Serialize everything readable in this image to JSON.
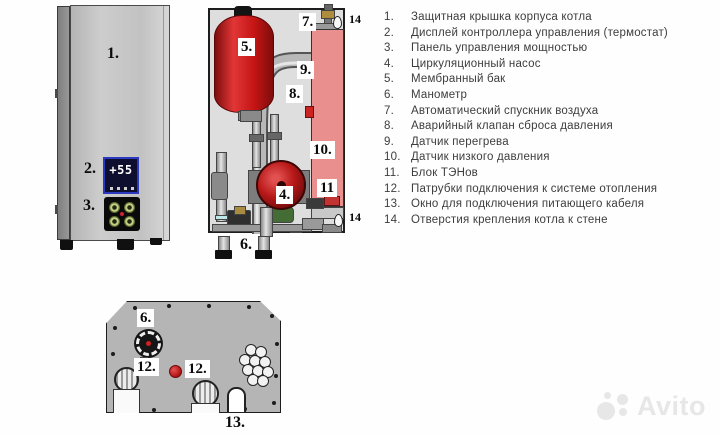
{
  "colors": {
    "tank_red": "#c41414",
    "pump_red": "#b81818",
    "heater_pink": "#e9908f",
    "panel_grey": "#c2c2c2",
    "display_navy": "#0e0e2e",
    "display_border_blue": "#2b38c0",
    "button_green": "#c3cf84",
    "watermark_grey": "#e3e3e3"
  },
  "front_view": {
    "callout_cover": "1.",
    "callout_display": "2.",
    "callout_power_panel": "3.",
    "display_value": "+55"
  },
  "internal_view": {
    "callout_pump": "4.",
    "callout_tank": "5.",
    "callout_manometer": "6.",
    "callout_air_vent": "7.",
    "callout_relief_valve": "8.",
    "callout_overheat_sensor": "9.",
    "callout_low_pressure_sensor": "10.",
    "callout_heater_block": "11",
    "callout_mount_hole_top": "14",
    "callout_mount_hole_bottom": "14"
  },
  "bottom_view": {
    "callout_manometer": "6.",
    "callout_pipe_left": "12.",
    "callout_pipe_right": "12.",
    "callout_cable_window": "13."
  },
  "legend": {
    "items": [
      {
        "num": "1.",
        "text": "Защитная крышка корпуса котла"
      },
      {
        "num": "2.",
        "text": "Дисплей контроллера управления (термостат)"
      },
      {
        "num": "3.",
        "text": "Панель управления мощностью"
      },
      {
        "num": "4.",
        "text": "Циркуляционный насос"
      },
      {
        "num": "5.",
        "text": "Мембранный бак"
      },
      {
        "num": "6.",
        "text": "Манометр"
      },
      {
        "num": "7.",
        "text": "Автоматический спускник воздуха"
      },
      {
        "num": "8.",
        "text": "Аварийный клапан сброса давления"
      },
      {
        "num": "9.",
        "text": "Датчик перегрева"
      },
      {
        "num": "10.",
        "text": "Датчик низкого давления"
      },
      {
        "num": "11.",
        "text": "Блок ТЭНов"
      },
      {
        "num": "12.",
        "text": "Патрубки подключения к системе отопления"
      },
      {
        "num": "13.",
        "text": "Окно для подключения питающего кабеля"
      },
      {
        "num": "14.",
        "text": "Отверстия крепления котла к стене"
      }
    ]
  },
  "watermark": {
    "brand": "Avito"
  }
}
